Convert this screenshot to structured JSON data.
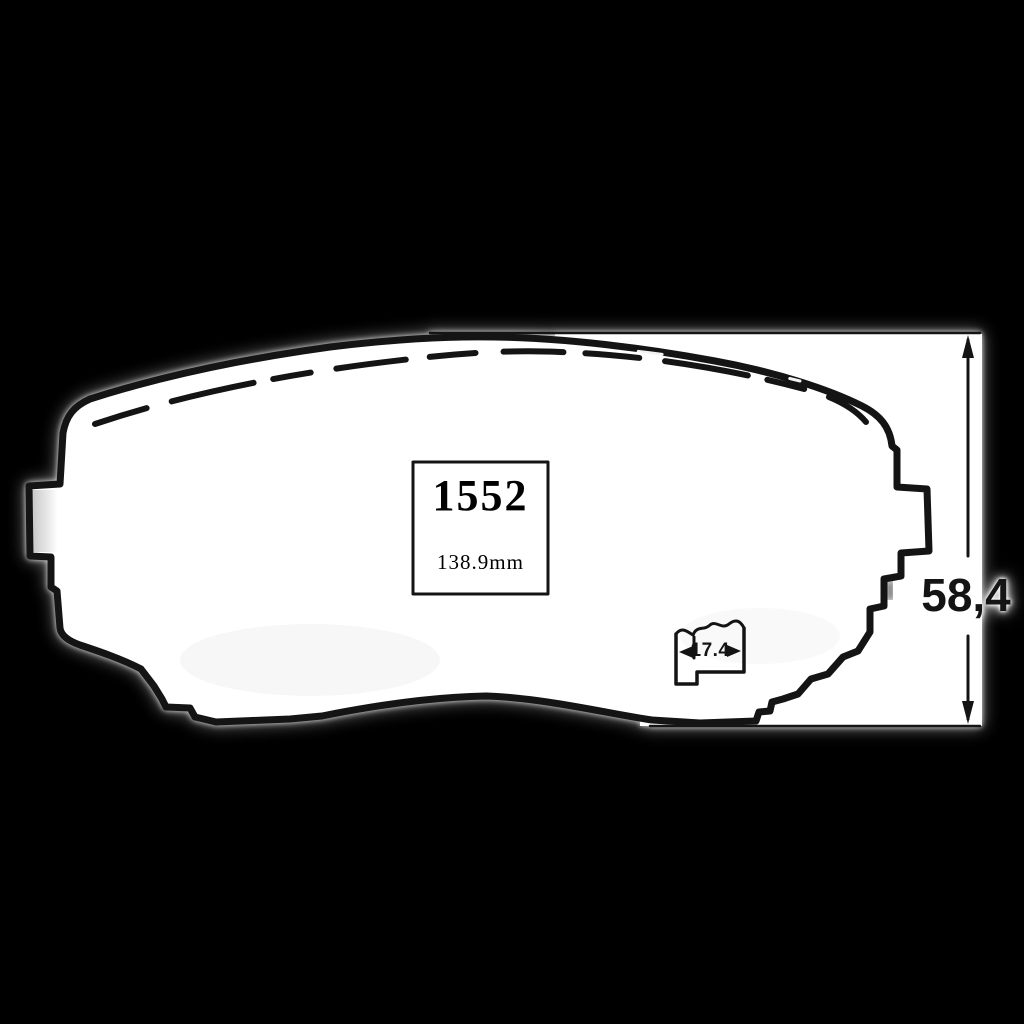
{
  "labels": {
    "part_number": "1552",
    "length": "138.9mm",
    "thickness": "17.4",
    "height": "58,4"
  },
  "colors": {
    "background": "#000000",
    "paper": "#ffffff",
    "ink": "#141414"
  }
}
